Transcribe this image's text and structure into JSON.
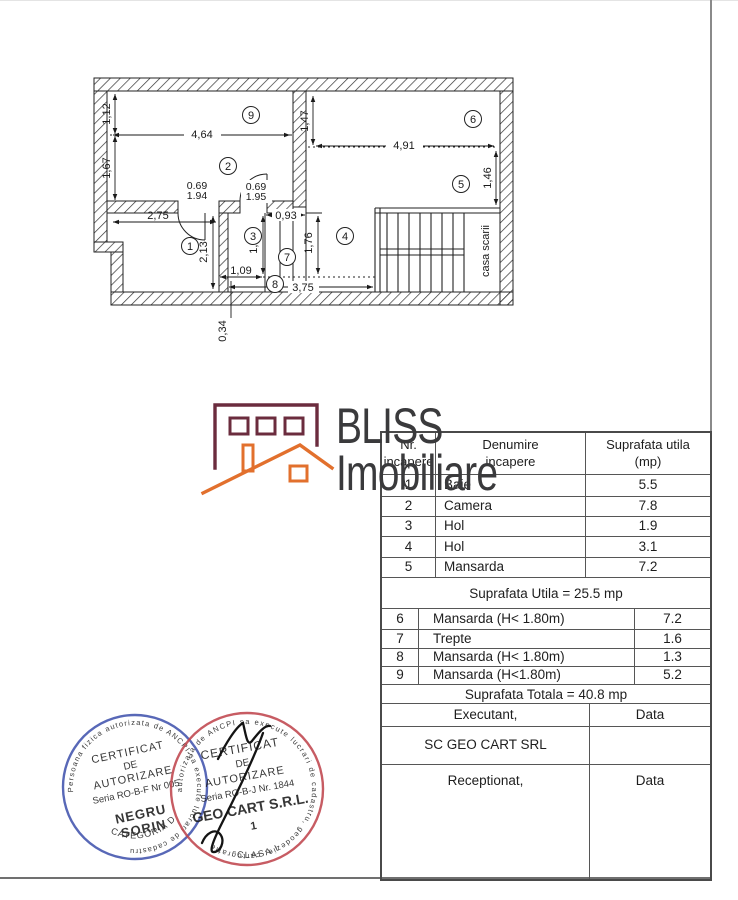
{
  "floorplan": {
    "rooms": {
      "r1": "1",
      "r2": "2",
      "r3": "3",
      "r4": "4",
      "r5": "5",
      "r6": "6",
      "r7": "7",
      "r8": "8",
      "r9": "9"
    },
    "dims": {
      "w112": "1,12",
      "w167": "1,67",
      "w464": "4,64",
      "w275": "2,75",
      "w213": "2,13",
      "d069a": "0.69",
      "d194": "1.94",
      "d069b": "0.69",
      "d195": "1.95",
      "w093": "0,93",
      "w176a": "1,76",
      "w176b": "1,76",
      "w109": "1,09",
      "w375": "3,75",
      "w034": "0,34",
      "w147": "1,47",
      "w491": "4,91",
      "w146": "1,46"
    },
    "labels": {
      "staircase": "casa scarii"
    }
  },
  "logo": {
    "line1": "BLISS",
    "line2": "Imobiliare",
    "house_color": "#6b2c3e",
    "roof_color": "#e2702d",
    "text_color": "#3a3a3c"
  },
  "table": {
    "headers": {
      "col1": "Nr.\nincapere",
      "col2": "Denumire\nincapere",
      "col3": "Suprafata utila\n(mp)"
    },
    "rows": [
      {
        "nr": "1",
        "name": "Baie",
        "val": "5.5"
      },
      {
        "nr": "2",
        "name": "Camera",
        "val": "7.8"
      },
      {
        "nr": "3",
        "name": "Hol",
        "val": "1.9"
      },
      {
        "nr": "4",
        "name": "Hol",
        "val": "3.1"
      },
      {
        "nr": "5",
        "name": "Mansarda",
        "val": "7.2"
      }
    ],
    "subtotal": "Suprafata Utila = 25.5 mp",
    "rows2": [
      {
        "nr": "6",
        "name": "Mansarda (H< 1.80m)",
        "val": "7.2"
      },
      {
        "nr": "7",
        "name": "Trepte",
        "val": "1.6"
      },
      {
        "nr": "8",
        "name": "Mansarda (H< 1.80m)",
        "val": "1.3"
      },
      {
        "nr": "9",
        "name": "Mansarda (H<1.80m)",
        "val": "5.2"
      }
    ],
    "total": "Suprafata Totala = 40.8 mp",
    "executant_label": "Executant,",
    "executant_data": "Data",
    "company": "SC GEO CART SRL",
    "receptionat_label": "Receptionat,",
    "receptionat_data": "Data"
  },
  "stamps": {
    "blue": {
      "color": "#4254ae",
      "ring": "Persoana fizica autorizata de ANCPI sa execute lucrari de cadastru",
      "l1": "CERTIFICAT",
      "l2": "DE",
      "l3": "AUTORIZARE",
      "l4": "Seria RO-B-F Nr 005",
      "l5": "NEGRU",
      "l6": "SORIN",
      "l7": "CATEGORIA D"
    },
    "red": {
      "color": "#c0464e",
      "ring": "autorizata de ANCPI sa execute lucrari de cadastru, geodezie, cartografie",
      "l1": "CERTIFICAT",
      "l2": "DE",
      "l3": "AUTORIZARE",
      "l4": "Seria RO-B-J Nr. 1844",
      "l5": "GEO CART S.R.L.",
      "l6": "1",
      "l7": "CLASA I"
    }
  }
}
